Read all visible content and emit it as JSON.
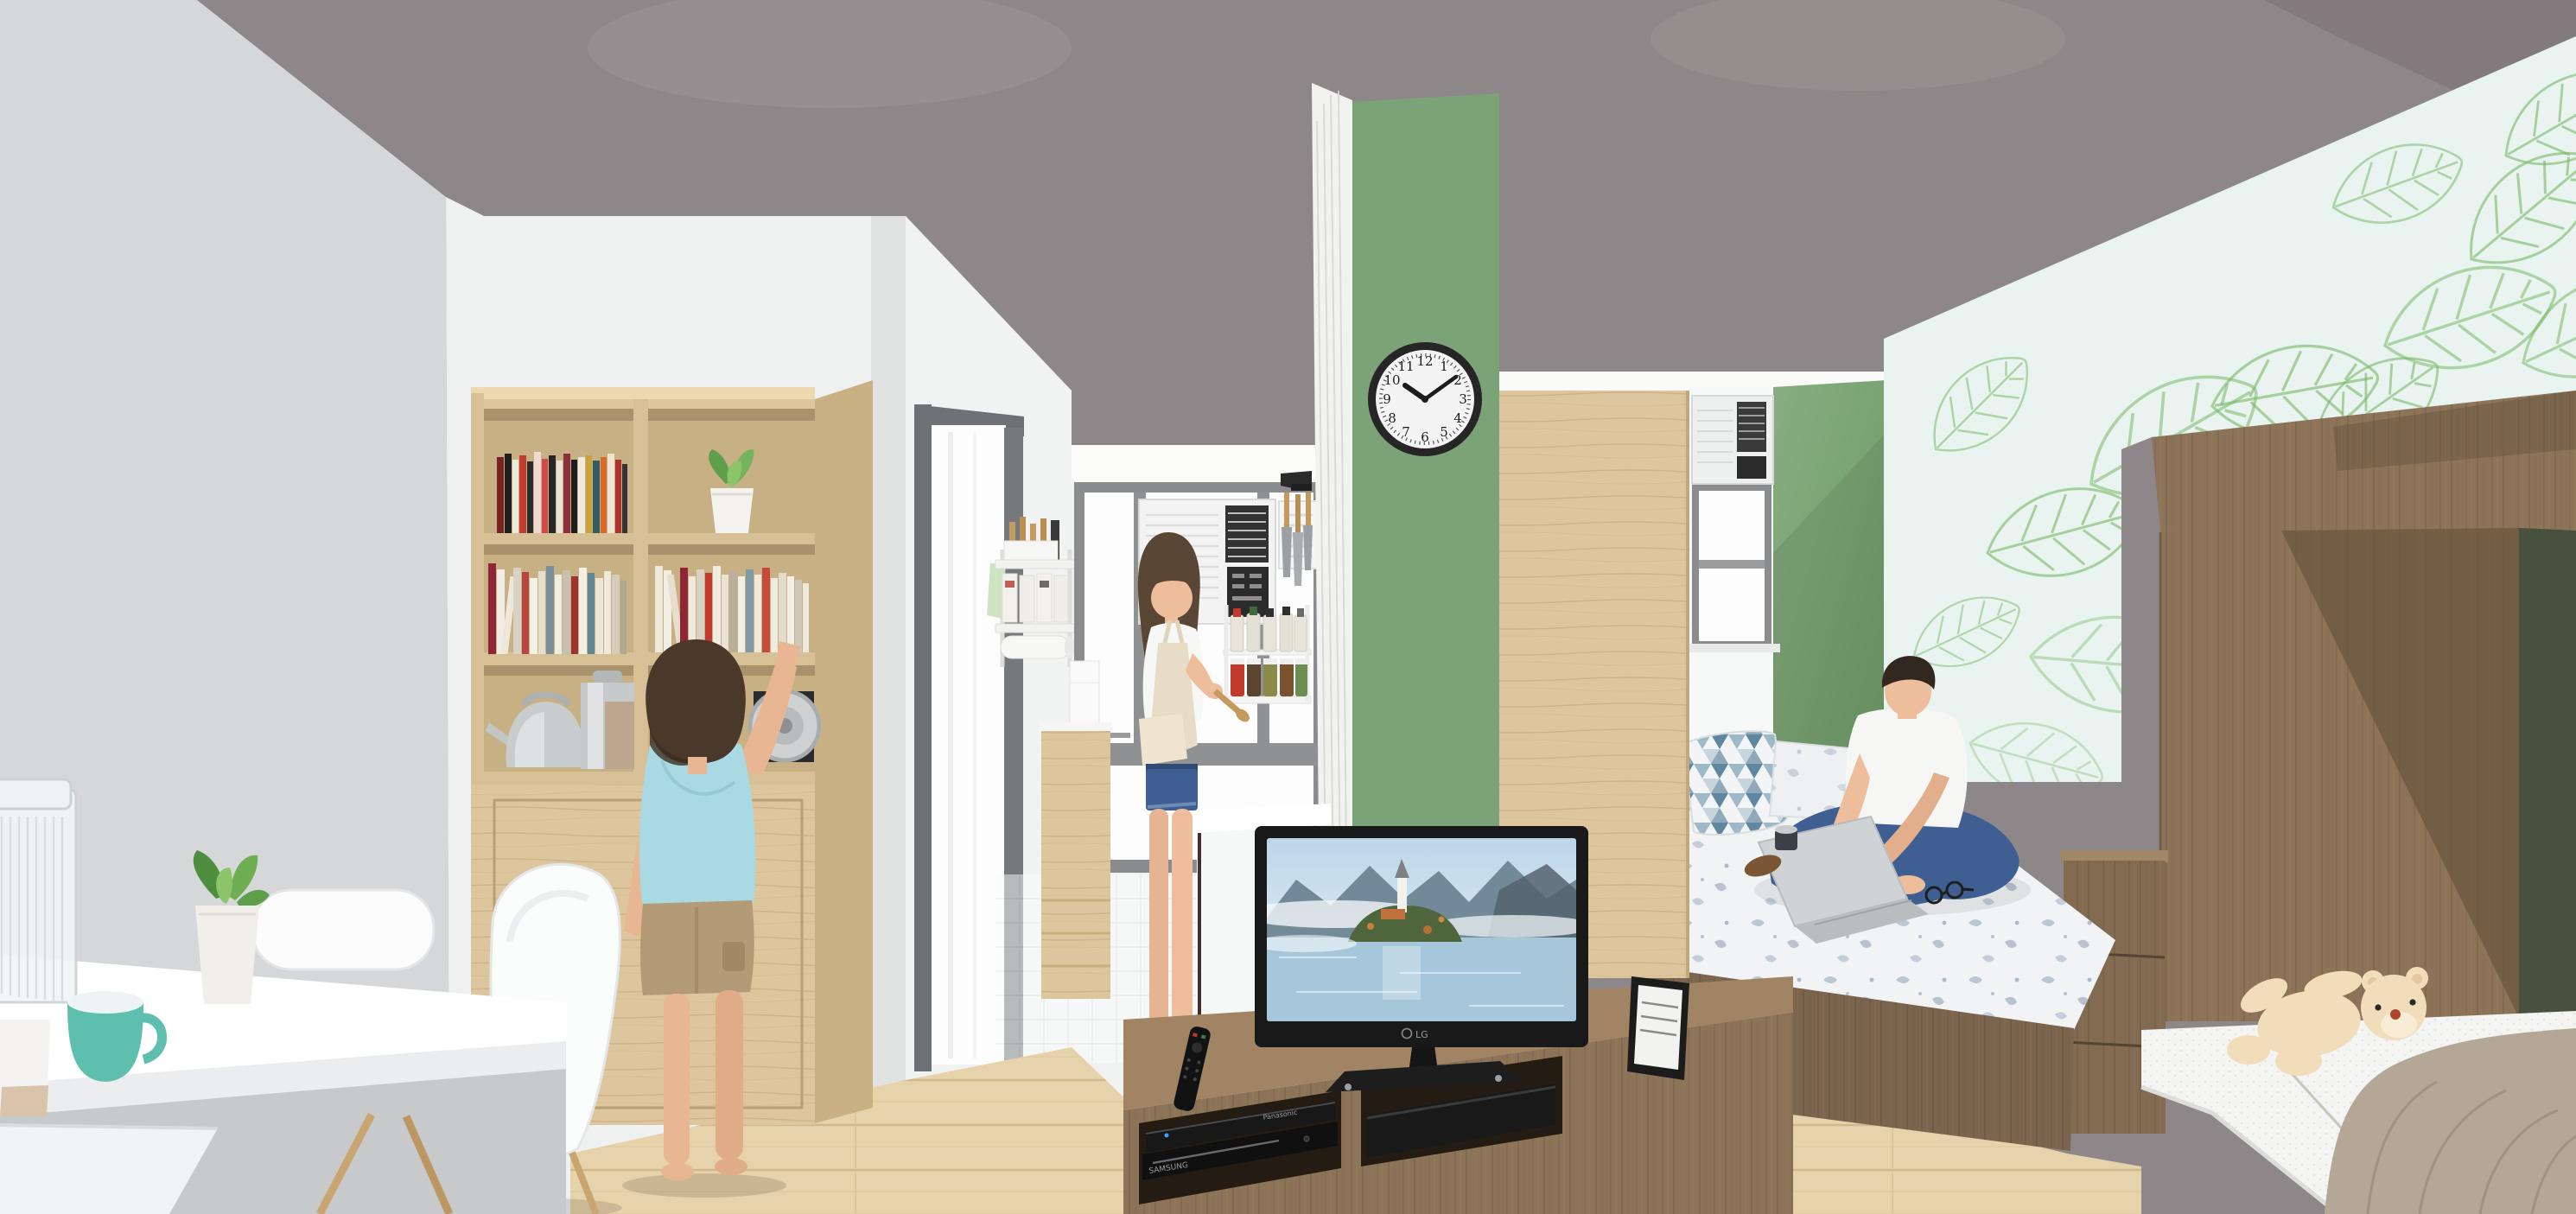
{
  "scene": {
    "type": "3D interior design rendering",
    "room": "compact family studio apartment",
    "areas": [
      "study desk",
      "bookshelf",
      "kitchen",
      "living TV area",
      "platform bed",
      "kids bed"
    ]
  },
  "clock": {
    "numerals": [
      "12",
      "1",
      "2",
      "3",
      "4",
      "5",
      "6",
      "7",
      "8",
      "9",
      "10",
      "11"
    ],
    "time": "10:09"
  },
  "tv": {
    "brand": "LG",
    "screen_scene": "island church on misty alpine lake"
  },
  "media": {
    "bluray_brand": "Panasonic",
    "dvd_brand": "SAMSUNG"
  },
  "aircon": {
    "brand": "Panasonic"
  },
  "colors": {
    "ceiling": "#8e8789",
    "ceilingDark": "#7d7678",
    "wallGrey": "#d6d7d8",
    "wallWhite": "#f1f2f2",
    "green": "#7ca377",
    "greenWall": "#7ba276",
    "leafBg": "#e9f3ef",
    "leafLine": "#79b968",
    "oak": "#ddc69e",
    "oakDeep": "#c6b084",
    "floor": "#e7d3ab",
    "floorLine": "#cbb286",
    "walnut": "#8d7459",
    "walnutDark": "#6b573f",
    "counter": "#fbfbfb",
    "teal": "#5fbfae",
    "skin": "#edbd9c",
    "hair": "#3c2f27",
    "denim": "#3f5f92",
    "blueTee": "#a9d9e2",
    "khaki": "#b29b76",
    "bedding": "#f2f3f5",
    "blanket": "#b5a795",
    "teddy": "#f2ddba",
    "tvBlack": "#191919"
  }
}
